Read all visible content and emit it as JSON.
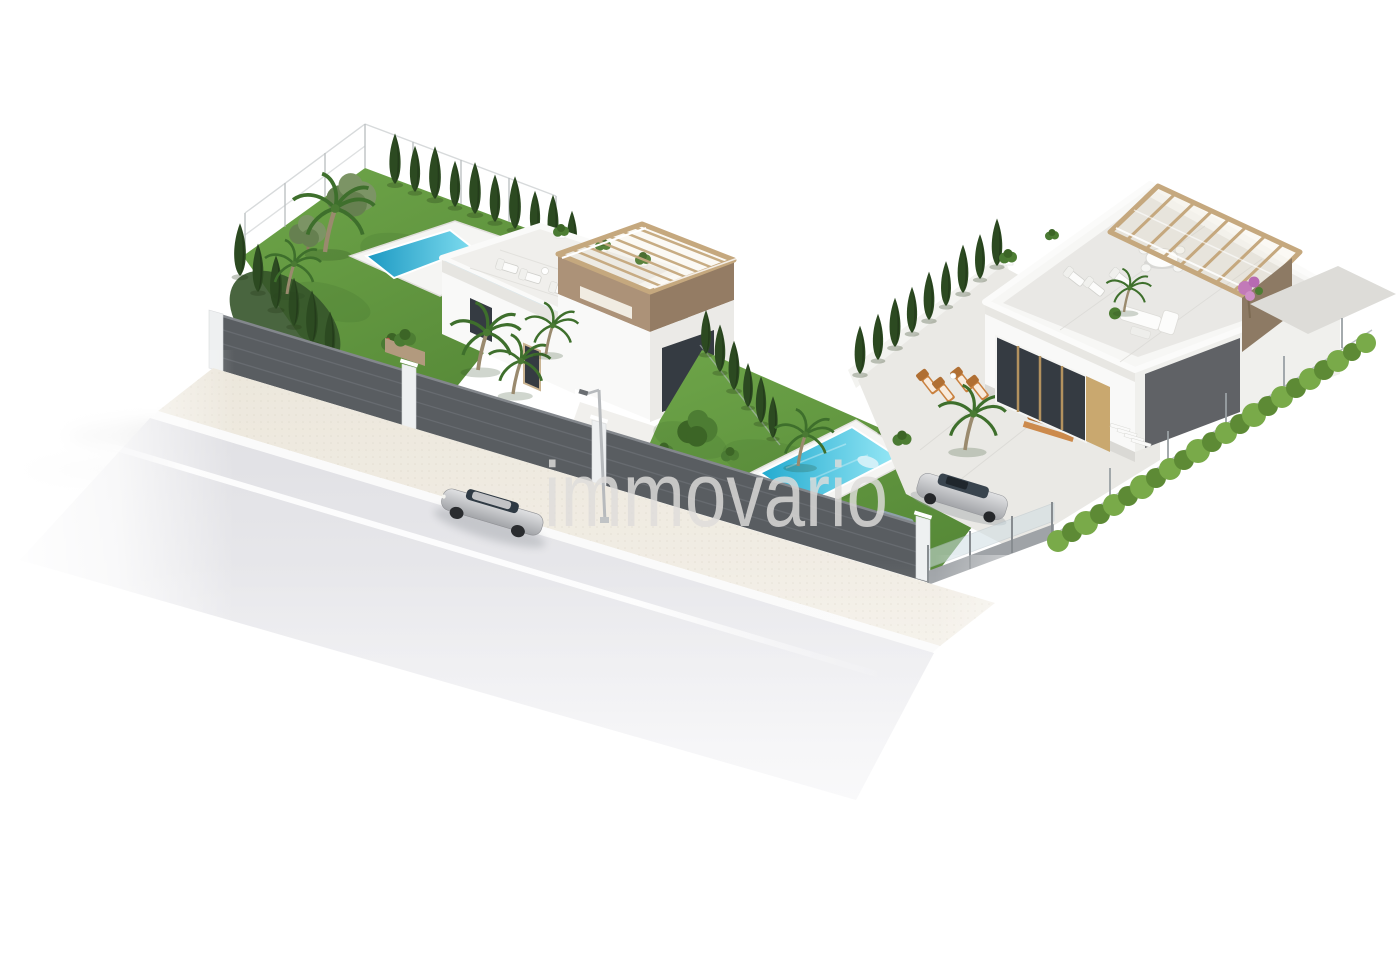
{
  "watermark": {
    "text": "immovario",
    "opacity": 0.82
  },
  "scene": {
    "kind": "aerial-3d-architectural-render",
    "villas": 2,
    "pools": 2,
    "cars_on_road": 1,
    "cars_parked_left_villa": 2,
    "cars_parked_right_villa": 2,
    "road_lane_lines": 1
  },
  "colors": {
    "lawn": "#6ea549",
    "lawn2": "#578a38",
    "cypress": "#2c4a21",
    "hedge": "#79aa49",
    "hedge2": "#5d8a35",
    "tree": "#4d7d33",
    "olive": "#7c9465",
    "palm": "#3e6f2c",
    "pool_deep": "#1b98c2",
    "pool_light": "#7edcef",
    "pool_deep2": "#21aacf",
    "pool_light2": "#97e8f6",
    "deck": "#f5f5f3",
    "road": "#e0e0e4",
    "road_light": "#f1f1f4",
    "sidewalk": "#ece7dc",
    "sidewalk_light": "#f3efe7",
    "curb": "#fafafa",
    "lane": "#ffffff",
    "stone": "#595d61",
    "stone2": "#74787e",
    "pillar": "#eef0f1",
    "white_wall": "#f9f9f8",
    "wall_shade": "#e6e5e1",
    "floor": "#e9e8e5",
    "wood": "#c5a87e",
    "wood2": "#a8885f",
    "band": "#ac9278",
    "band2": "#947c64",
    "brown_wall": "#8d7a64",
    "gray_panel": "#606266",
    "glass": "#353b42",
    "car_silver_hi": "#e0e1e3",
    "car_silver_lo": "#a2a4a8",
    "car_dark": "#454a52",
    "car_white": "#eef0f1",
    "pink": "#c27ab8",
    "furn": "#c9813f",
    "wm": "#dfdddb"
  }
}
